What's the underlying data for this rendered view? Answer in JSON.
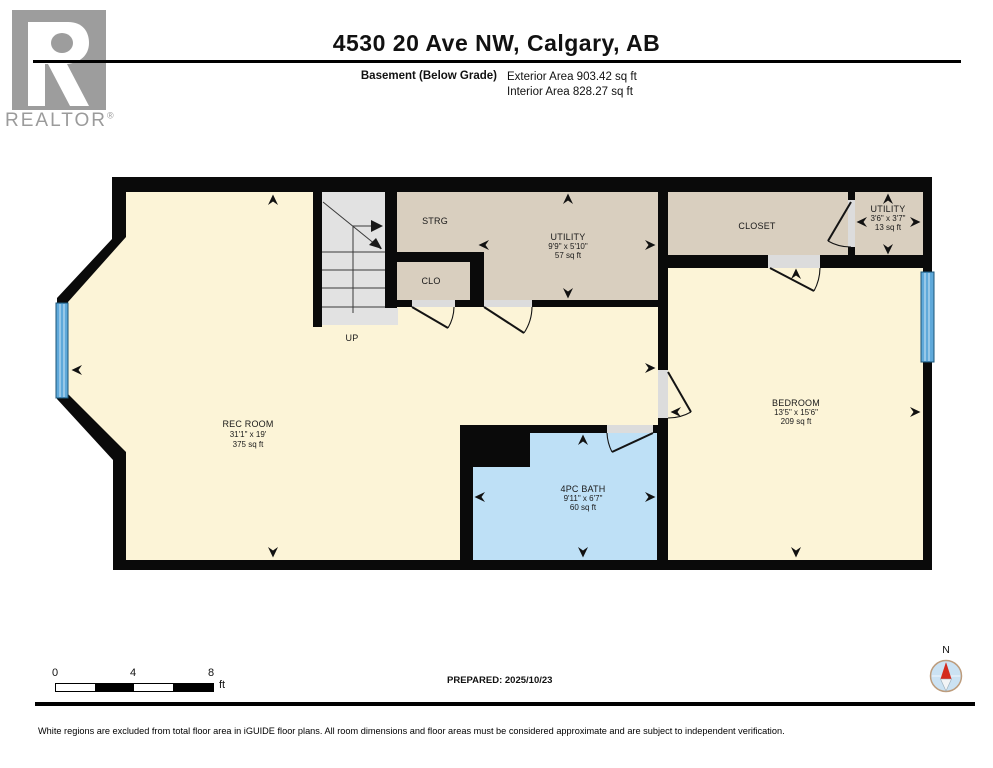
{
  "header": {
    "title": "4530 20 Ave NW, Calgary, AB",
    "floor_label": "Basement (Below Grade)",
    "exterior_area": "Exterior Area 903.42 sq ft",
    "interior_area": "Interior Area 828.27 sq ft"
  },
  "logo": {
    "brand": "REALTOR",
    "reg": "®"
  },
  "rooms": {
    "rec": {
      "name": "REC ROOM",
      "dims": "31'1\" x 19'",
      "area": "375 sq ft"
    },
    "bedroom": {
      "name": "BEDROOM",
      "dims": "13'5\" x 15'6\"",
      "area": "209 sq ft"
    },
    "bath": {
      "name": "4PC BATH",
      "dims": "9'11\" x 6'7\"",
      "area": "60 sq ft"
    },
    "utility_main": {
      "name": "UTILITY",
      "dims": "9'9\" x 5'10\"",
      "area": "57 sq ft"
    },
    "utility_small": {
      "name": "UTILITY",
      "dims": "3'6\" x 3'7\"",
      "area": "13 sq ft"
    },
    "strg": {
      "name": "STRG"
    },
    "clo": {
      "name": "CLO"
    },
    "closet": {
      "name": "CLOSET"
    },
    "stairs": {
      "label": "UP"
    }
  },
  "footer": {
    "scale": {
      "tick0": "0",
      "tick1": "4",
      "tick2": "8",
      "unit": "ft"
    },
    "prepared": "PREPARED: 2025/10/23",
    "compass": "N",
    "disclaimer": "White regions are excluded from total floor area in iGUIDE floor plans. All room dimensions and floor areas must be considered approximate and are subject to independent verification."
  },
  "colors": {
    "floor_cream": "#FCF4D7",
    "room_beige": "#D9CFBF",
    "bath_blue": "#BEE0F6",
    "window_blue": "#5FA9DA",
    "stair_gray": "#E2E2E2",
    "wall_black": "#0A0A0A",
    "logo_gray": "#9D9D9D",
    "compass_red": "#D42B1E"
  }
}
